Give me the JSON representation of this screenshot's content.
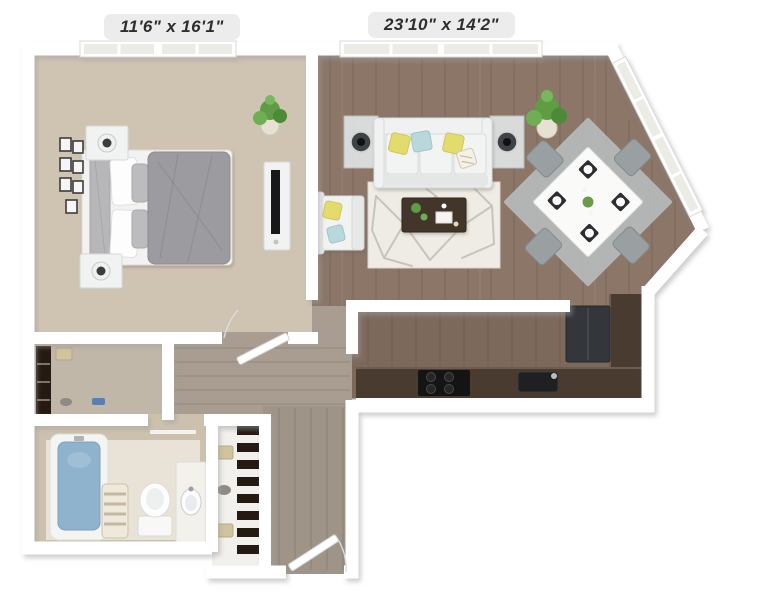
{
  "labels": {
    "bedroom_dimensions": "11'6\" x 16'1\"",
    "living_dining_dimensions": "23'10\" x 14'2\""
  },
  "plan": {
    "type": "3d-top-down-floor-plan",
    "rooms": [
      "bedroom",
      "living-room",
      "dining-area",
      "kitchen",
      "bathroom",
      "walk-in-closet",
      "linen-closet",
      "entry-hall",
      "hallway"
    ],
    "furniture": {
      "bedroom": [
        "bed",
        "headboard",
        "nightstand-with-lamp",
        "nightstand-with-lamp",
        "wall-art-frames",
        "tv-console",
        "potted-plant",
        "windows"
      ],
      "living_room": [
        "sofa",
        "yellow-pillows",
        "blue-pillows",
        "side-table-with-lamp",
        "side-table-with-lamp",
        "geometric-area-rug",
        "coffee-table",
        "armchair",
        "potted-plant",
        "windows"
      ],
      "dining_area": [
        "square-dining-table",
        "four-chairs",
        "gray-rug",
        "place-settings",
        "corner-windows"
      ],
      "kitchen": [
        "l-shaped-counter",
        "cooktop",
        "sink",
        "refrigerator"
      ],
      "bathroom": [
        "bathtub",
        "shower-curtain",
        "toilet",
        "vanity-sink",
        "towel-bar"
      ],
      "closets": [
        "walk-in-closet-shelves",
        "linen-shelves",
        "storage-baskets"
      ],
      "doors": [
        "bedroom-door",
        "entry-door"
      ]
    }
  },
  "colors": {
    "wall": "#ffffff",
    "wall_shadow": "#9e9e9e",
    "carpet": "#cfc4b2",
    "living_wood": "#8b7668",
    "hall_wood": "#a89d90",
    "kitchen_wood": "#7d695c",
    "entry_wood": "#9f9488",
    "bath_wall": "#cdc1ae",
    "counter": "#4a3b31",
    "refrigerator": "#33363a",
    "stove": "#141414",
    "rug": "#eeece4",
    "dining_rug": "#b6bbbb",
    "sofa": "#e9ebea",
    "pillow_yellow": "#e3dc6d",
    "pillow_blue": "#b9d8dc",
    "coffee_table": "#42342b",
    "duvet": "#9c9ca0",
    "bathtub": "#8fb3cd",
    "plant": "#5f9c44",
    "basket": "#cfc49e",
    "label_bg": "#ececec",
    "label_text": "#2e2e2e"
  }
}
